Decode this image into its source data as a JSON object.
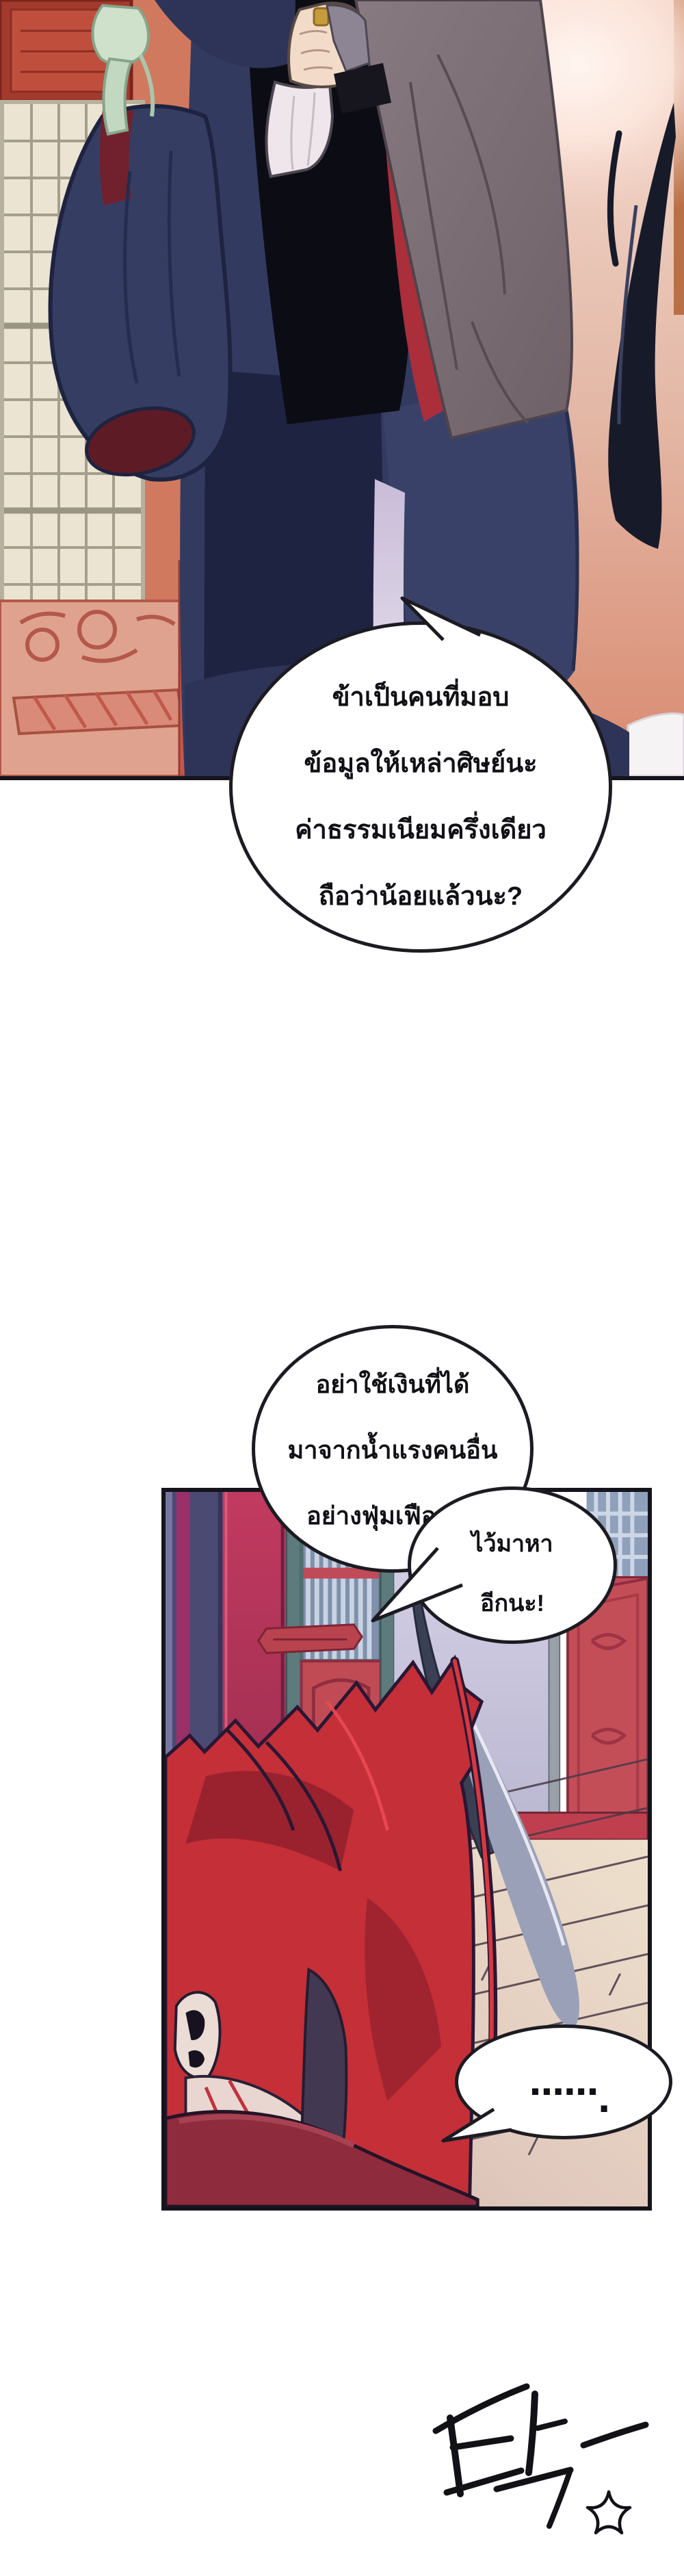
{
  "colors": {
    "page_bg": "#ffffff",
    "panel_border": "#15141c",
    "bubble_fill": "#ffffff",
    "bubble_border": "#1c1b22",
    "text_ink": "#111015",
    "sfx_ink": "#121116",
    "wall_salmon": "#d1795f",
    "lattice_cream": "#ebe4d3",
    "robe_navy": "#333a60",
    "robe_black": "#0c0d14",
    "robe_gray": "#7b6e74",
    "lining_red": "#ab2e3b",
    "ribbon_mint": "#cfe0cb",
    "glow_pink": "#fff5f0",
    "hair_black": "#171a29",
    "pillar_purple": "#4b4a72",
    "pillar_crimson": "#b8385c",
    "door_red": "#c14b55",
    "doorway_lavender": "#d5d0e6",
    "floor_light": "#e9dbca",
    "hair_red": "#c52f38",
    "skin_pale": "#ecdcd6",
    "shirt_maroon": "#8e2b3c"
  },
  "bubbles": {
    "b1": {
      "lines": [
        "ข้าเป็นคนที่มอบ",
        "ข้อมูลให้เหล่าศิษย์นะ",
        "ค่าธรรมเนียมครึ่งเดียว",
        "ถือว่าน้อยแล้วนะ?"
      ]
    },
    "b2": {
      "lines": [
        "อย่าใช้เงินที่ได้",
        "มาจากน้ำแรงคนอื่น",
        "อย่างฟุ่มเฟือยล่ะ"
      ]
    },
    "b3": {
      "lines": [
        "ไว้มาหา",
        "อีกนะ!"
      ]
    },
    "b4": {
      "dots": "......",
      "period": "."
    }
  },
  "sfx": {
    "glyph": "탁-"
  }
}
